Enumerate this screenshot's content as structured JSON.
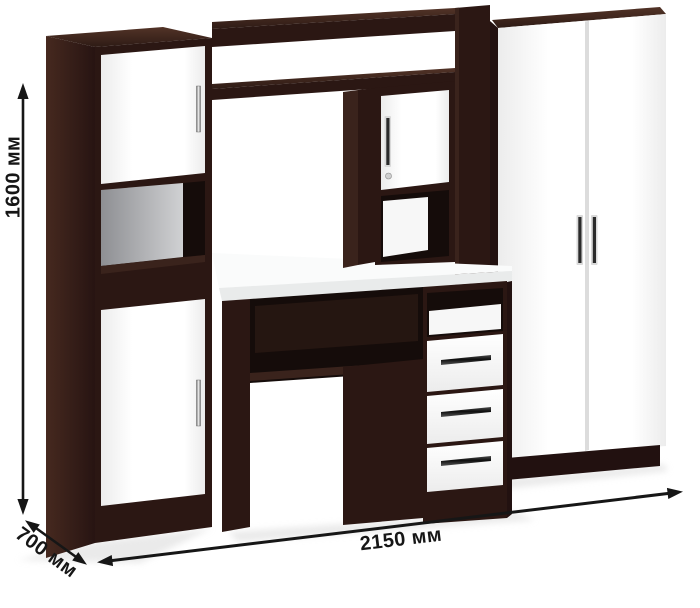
{
  "dimensions": {
    "height": "1600 мм",
    "depth": "700 мм",
    "width": "2150 мм"
  },
  "colors": {
    "bg": "#ffffff",
    "ink": "#161616",
    "wengeFront": "#2b1713",
    "wengeFrontDark": "#221110",
    "wengeMid": "#3a231c",
    "wengeDeep": "#150c0a",
    "wengeSideA": "#46291f",
    "wengeSideB": "#271412",
    "wengeTopA": "#523327",
    "wengeTopB": "#2e1b15",
    "panelWhiteA": "#ffffff",
    "panelWhiteB": "#ececec",
    "grayBackA": "#8e8f93",
    "grayBackB": "#d0d1d3",
    "desktopTop": "#fafbfb",
    "desktopEdge": "#e9ebeb",
    "doorGap": "#dcdcdc",
    "nicheBack": "#f7f7f7",
    "handleHalo": "#d9d9d9",
    "handleDark": "#2b2b2b",
    "silverA": "#6e6e6e",
    "silverB": "#f5f5f5",
    "shadow": "#d9d9d9"
  }
}
